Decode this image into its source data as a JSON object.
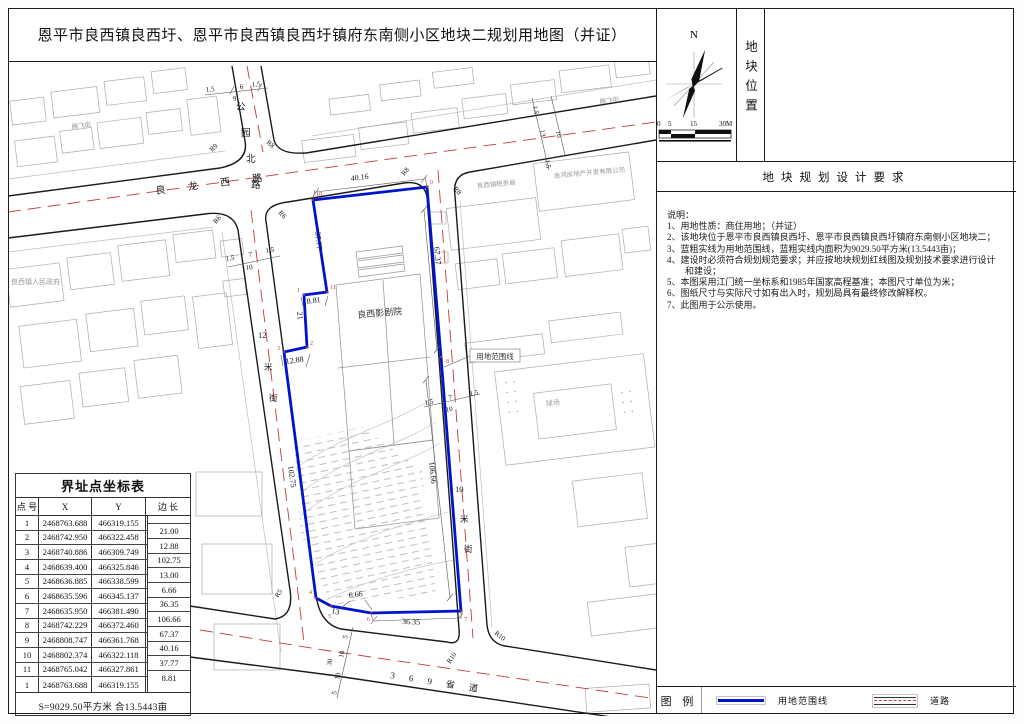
{
  "title": "恩平市良西镇良西圩、恩平市良西镇良西圩镇府东南侧小区地块二规划用地图（并证）",
  "colors": {
    "boundary": "#0014cc",
    "road_center": "#c23b3b",
    "building": "#aaaaaa"
  },
  "panel": {
    "location_label": "地块位置",
    "north_label": "N",
    "scale_ticks": [
      "0",
      "5",
      "15",
      "30M"
    ],
    "requirements_title": "地块规划设计要求",
    "notes_heading": "说明：",
    "notes": [
      "1、用地性质：商住用地；（并证）",
      "2、该地块位于恩平市良西镇良西圩、恩平市良西镇良西圩镇府东南侧小区地块二；",
      "3、蓝粗实线为用地范围线，蓝粗实线内面积为9029.50平方米(13.5443亩)；",
      "4、建设时必须符合规划规范要求；并应按地块规划红线图及规划技术要求进行设计",
      "　　和建设；",
      "5、本图采用江门统一坐标系和1985年国家高程基准；本图尺寸单位为米；",
      "6、图纸尺寸与实际尺寸如有出入时，规划局具有最终修改解释权。",
      "7、此图用于公示使用。"
    ],
    "legend": {
      "label": "图 例",
      "boundary": "用地范围线",
      "road": "道路"
    }
  },
  "table": {
    "title": "界址点坐标表",
    "headers": [
      "点 号",
      "X",
      "Y",
      "边 长"
    ],
    "rows": [
      {
        "no": "1",
        "x": "2468763.688",
        "y": "466319.155"
      },
      {
        "no": "2",
        "x": "2468742.950",
        "y": "466322.458"
      },
      {
        "no": "3",
        "x": "2468740.886",
        "y": "466309.749"
      },
      {
        "no": "4",
        "x": "2468639.400",
        "y": "466325.846"
      },
      {
        "no": "5",
        "x": "2468636.885",
        "y": "466338.599"
      },
      {
        "no": "6",
        "x": "2468635.596",
        "y": "466345.137"
      },
      {
        "no": "7",
        "x": "2468635.950",
        "y": "466381.490"
      },
      {
        "no": "8",
        "x": "2468742.229",
        "y": "466372.460"
      },
      {
        "no": "9",
        "x": "2468808.747",
        "y": "466361.768"
      },
      {
        "no": "10",
        "x": "2468802.374",
        "y": "466322.118"
      },
      {
        "no": "11",
        "x": "2468765.042",
        "y": "466327.861"
      },
      {
        "no": "1",
        "x": "2468763.688",
        "y": "466319.155"
      }
    ],
    "edges": [
      "21.00",
      "12.88",
      "102.75",
      "13.00",
      "6.66",
      "36.35",
      "106.66",
      "67.37",
      "40.16",
      "37.77",
      "8.81"
    ],
    "footer": "S=9029.50平方米 合13.5443亩"
  },
  "map": {
    "road_names": {
      "lianglong": "良 龙 西 路",
      "gongyuan": [
        "公",
        "园",
        "北",
        "路"
      ],
      "street12": [
        "12",
        "米",
        "街"
      ],
      "street10": [
        "10",
        "米",
        "街"
      ],
      "provincial": "3  6  9  省  道",
      "tengfei_left": "腾飞街",
      "tengfei_right": "腾飞街"
    },
    "places": {
      "government": "良西镇人民政府",
      "company": "金鸿房地产开发有限公司",
      "tax_office": "良西镇税务局",
      "theater": "良西影剧院",
      "court": "球场",
      "boundary_callout": "用地范围线"
    },
    "dims": {
      "top": "40.16",
      "left_upper": "37.77",
      "notch": "8.81",
      "l21": "21",
      "l1288": "12.88",
      "left_long": "102.75",
      "b13": "13",
      "b666": "6.66",
      "bottom": "36.35",
      "right_lower": "106.66",
      "right_upper": "67.37"
    },
    "widths": {
      "gongyuan": [
        "1.5",
        "6",
        "1.5",
        "9"
      ],
      "lianglong": [
        "1.5",
        "13",
        "16",
        "1.5"
      ],
      "street12": [
        "1.5",
        "7",
        "1.5",
        "10"
      ],
      "street10": [
        "1.5",
        "7",
        "1.5",
        "10"
      ],
      "provincial": [
        "5",
        "10",
        "30",
        "10",
        "5"
      ]
    },
    "radii": {
      "r9": "R9",
      "r8_top": "R8",
      "r6_w": "R6",
      "r6_e": "R6",
      "r8_w": "R8",
      "r8_e": "R8",
      "r5": "R5",
      "r10_w": "R10",
      "r10_e": "R10"
    },
    "vertices": [
      "1",
      "2",
      "3",
      "4",
      "5",
      "6",
      "7",
      "8",
      "9",
      "10",
      "11"
    ]
  }
}
